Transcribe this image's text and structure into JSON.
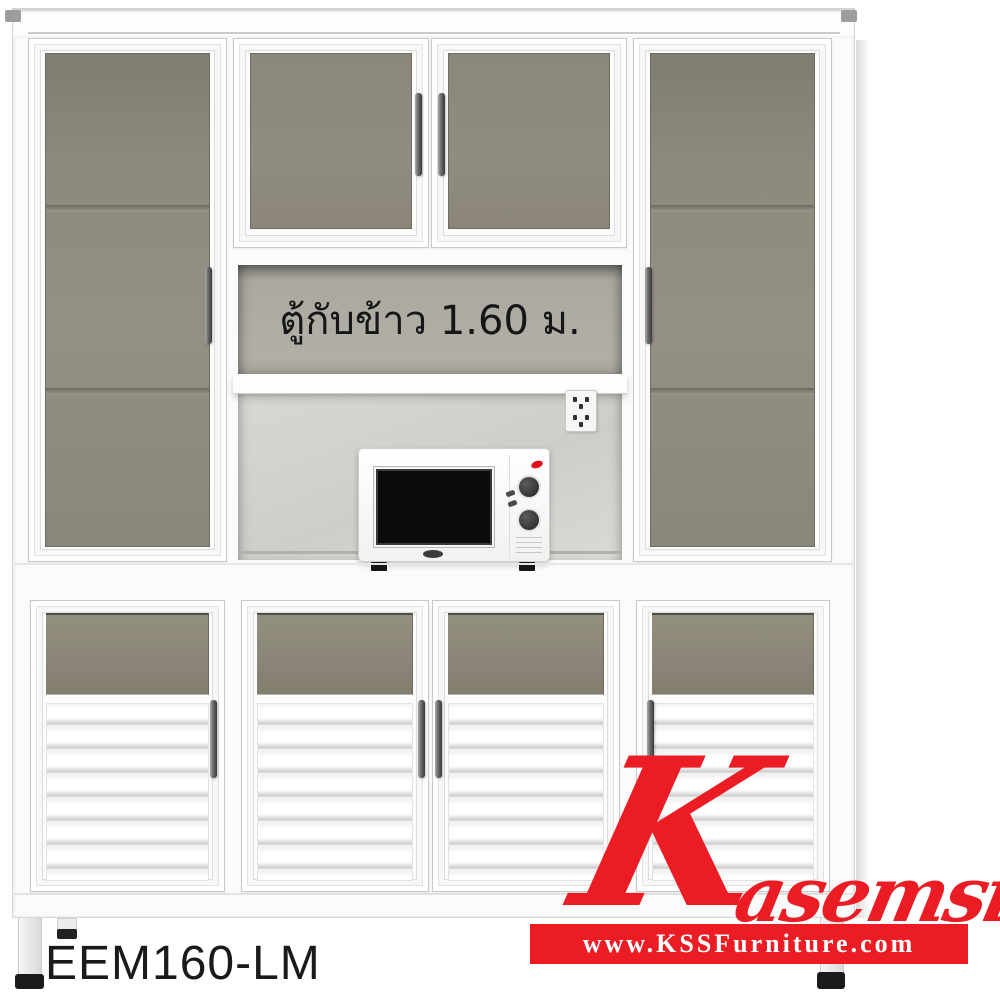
{
  "product": {
    "label_thai": "ตู้กับข้าว 1.60 ม.",
    "code": "EEM160-LM"
  },
  "watermark": {
    "brand_script": "Kasemsiri",
    "brand_initial": "K",
    "brand_rest": "asemsiri",
    "website": "www.KSSFurniture.com"
  },
  "colors": {
    "accent_red": "#EC1C24",
    "glass_gray": "#8B877A",
    "niche_wall_gray": "#AAA89F",
    "text_black": "#1A1A1A"
  }
}
